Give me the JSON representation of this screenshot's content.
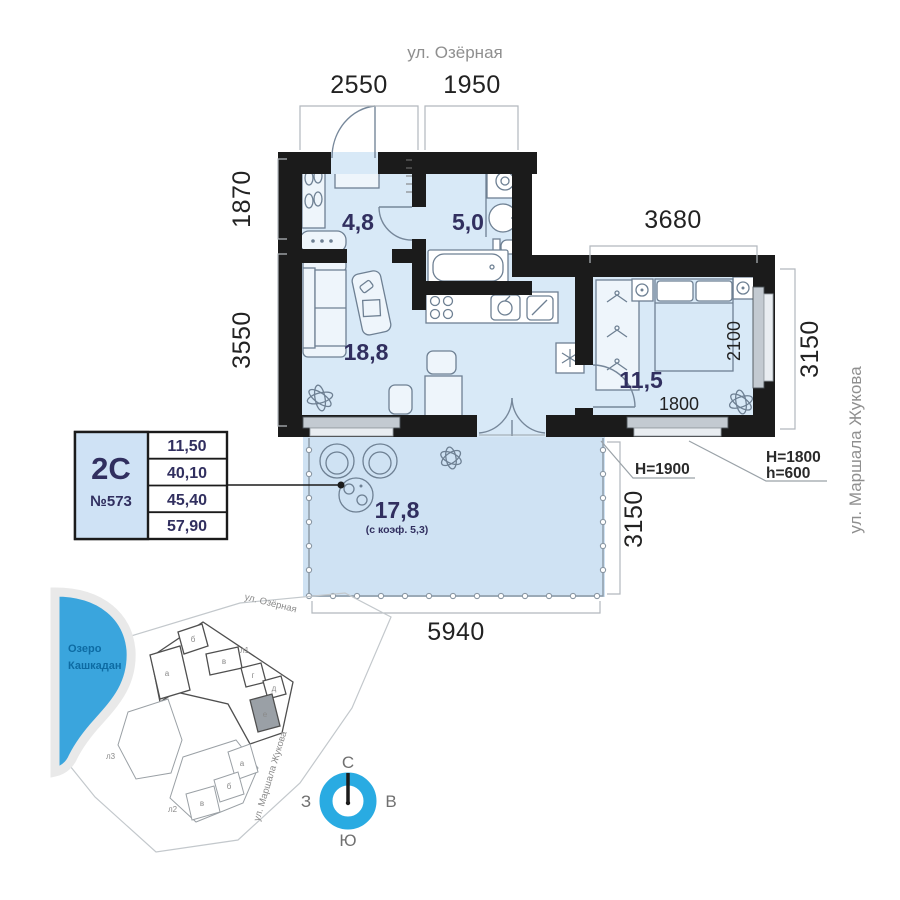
{
  "streets": {
    "ozernaya": "ул. Озёрная",
    "zhukova": "ул. Маршала Жукова"
  },
  "info_card": {
    "plan_type": "2С",
    "apartment_number": "№573",
    "areas": [
      "11,50",
      "40,10",
      "45,40",
      "57,90"
    ]
  },
  "rooms": {
    "hall": "4,8",
    "bathroom": "5,0",
    "living_kitchen": "18,8",
    "bedroom": "11,5",
    "terrace": "17,8",
    "terrace_note": "(с коэф. 5,3)"
  },
  "dimensions": {
    "top_left": "2550",
    "top_right": "1950",
    "left_upper": "1870",
    "left_lower": "3550",
    "bedroom_top": "3680",
    "bedroom_right": "3150",
    "bedroom_window": "2100",
    "bedroom_window_bottom": "1800",
    "terrace_right": "3150",
    "terrace_bottom": "5940"
  },
  "heights": {
    "terrace_door": "H=1900",
    "bedroom_window": "H=1800",
    "bedroom_sill": "h=600"
  },
  "site_map": {
    "lake_line1": "Озеро",
    "lake_line2": "Кашкадан",
    "street_top": "ул. Озёрная",
    "street_right": "ул. Маршала Жукова",
    "labels": {
      "l1": "л1",
      "l2": "л2",
      "l3": "л3",
      "a_up": "а",
      "b_up": "б",
      "v_up": "в",
      "g_up": "г",
      "d_up": "д",
      "e_up": "е",
      "a_low": "а",
      "b_low": "б",
      "v_low": "в"
    }
  },
  "compass": {
    "north": "С",
    "east": "В",
    "south": "Ю",
    "west": "З"
  },
  "colors": {
    "room_fill": "#d8e9f7",
    "terrace_fill": "#cfe2f3",
    "wall": "#1b1b1b",
    "accent_navy": "#312f5f",
    "lake_blue": "#3aa5dd",
    "compass_blue": "#29abe2"
  }
}
